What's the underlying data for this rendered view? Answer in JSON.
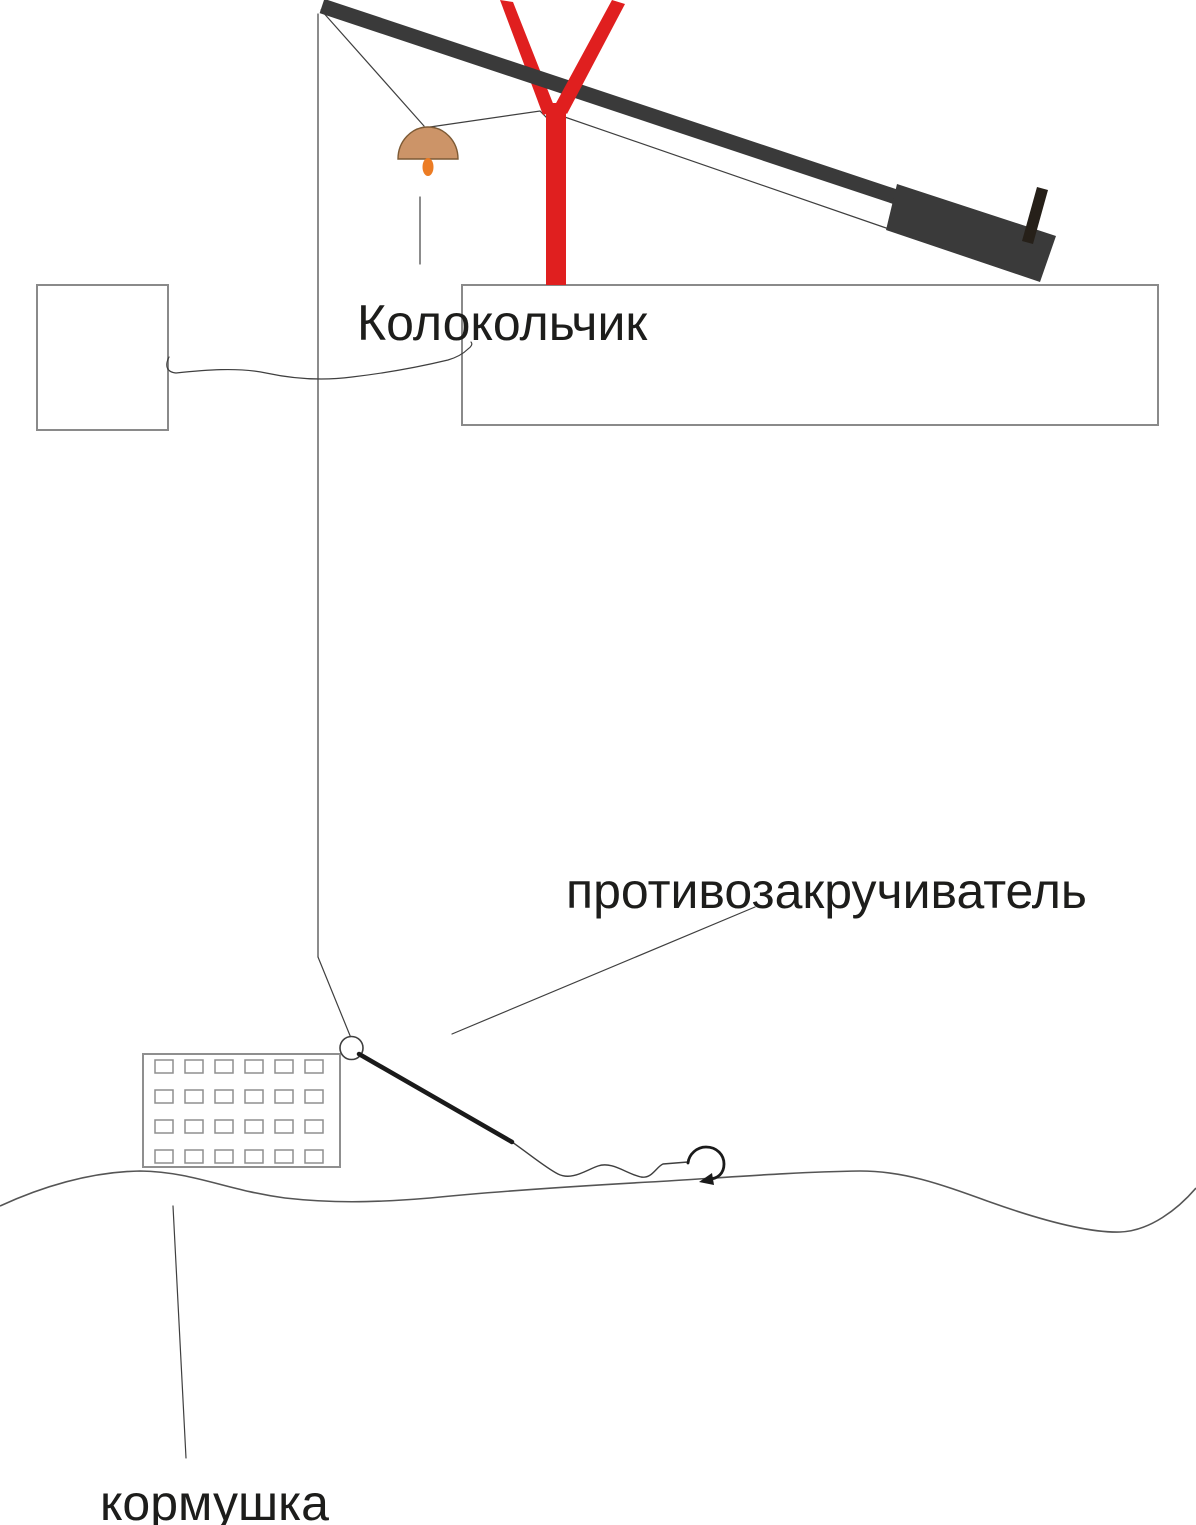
{
  "labels": {
    "bell": "Колокольчик",
    "anti_twist": "противозакручиватель",
    "feeder": "кормушка"
  },
  "colors": {
    "rod": "#3a3a3a",
    "reel": "#262019",
    "rod_rest": "#e01f1f",
    "bell_dome": "#cc9468",
    "bell_outline": "#7d5a35",
    "bell_clapper": "#ec7c24",
    "line": "#3f3f3f",
    "tube": "#1a1a1a",
    "box_border": "#8a8a8a",
    "feeder_border": "#8f8f8f",
    "ground": "#555555",
    "text": "#1d1d1b"
  }
}
